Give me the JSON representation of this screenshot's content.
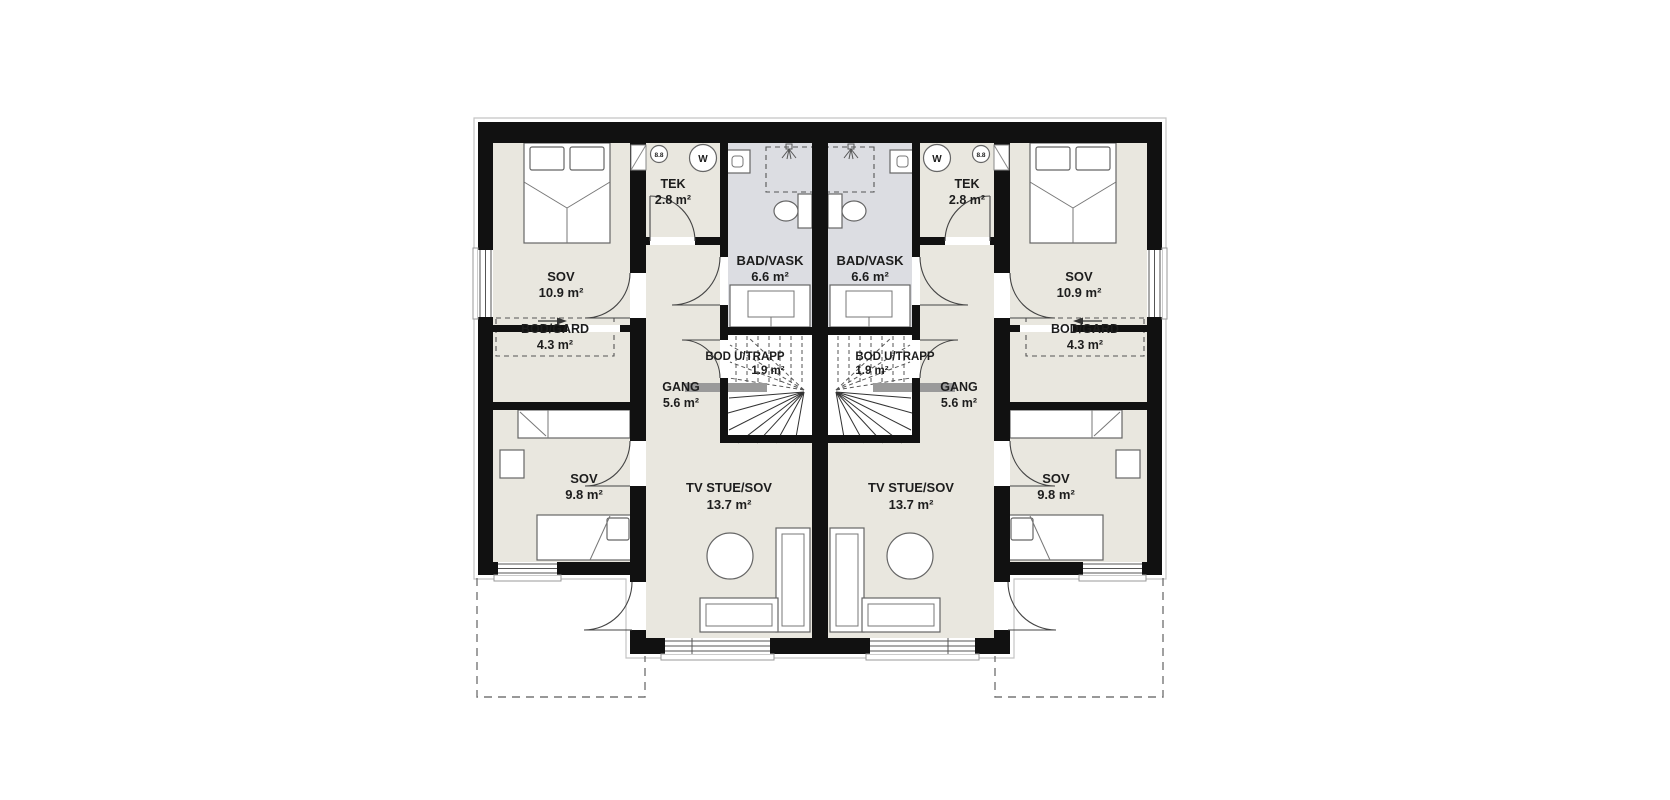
{
  "plan": {
    "type": "floor-plan",
    "units": "2 mirrored dwelling units (duplex), upper floor",
    "rooms": {
      "sov_large": {
        "name": "SOV",
        "area": "10.9 m²"
      },
      "bod_gard": {
        "name": "BOD/GARD",
        "area": "4.3 m²"
      },
      "sov_small": {
        "name": "SOV",
        "area": "9.8 m²"
      },
      "tek": {
        "name": "TEK",
        "area": "2.8 m²"
      },
      "bad_vask": {
        "name": "BAD/VASK",
        "area": "6.6 m²"
      },
      "bod_u_trapp": {
        "name": "BOD U/TRAPP",
        "area": "1.9 m²"
      },
      "gang": {
        "name": "GANG",
        "area": "5.6 m²"
      },
      "tv_stue": {
        "name": "TV STUE/SOV",
        "area": "13.7 m²"
      }
    },
    "icons": {
      "washer_label": "W",
      "heater_label": "8.8"
    },
    "colors": {
      "wall": "#111111",
      "floor": "#e9e7df",
      "bath_floor": "#dcdde2",
      "dashed": "#555555"
    }
  }
}
